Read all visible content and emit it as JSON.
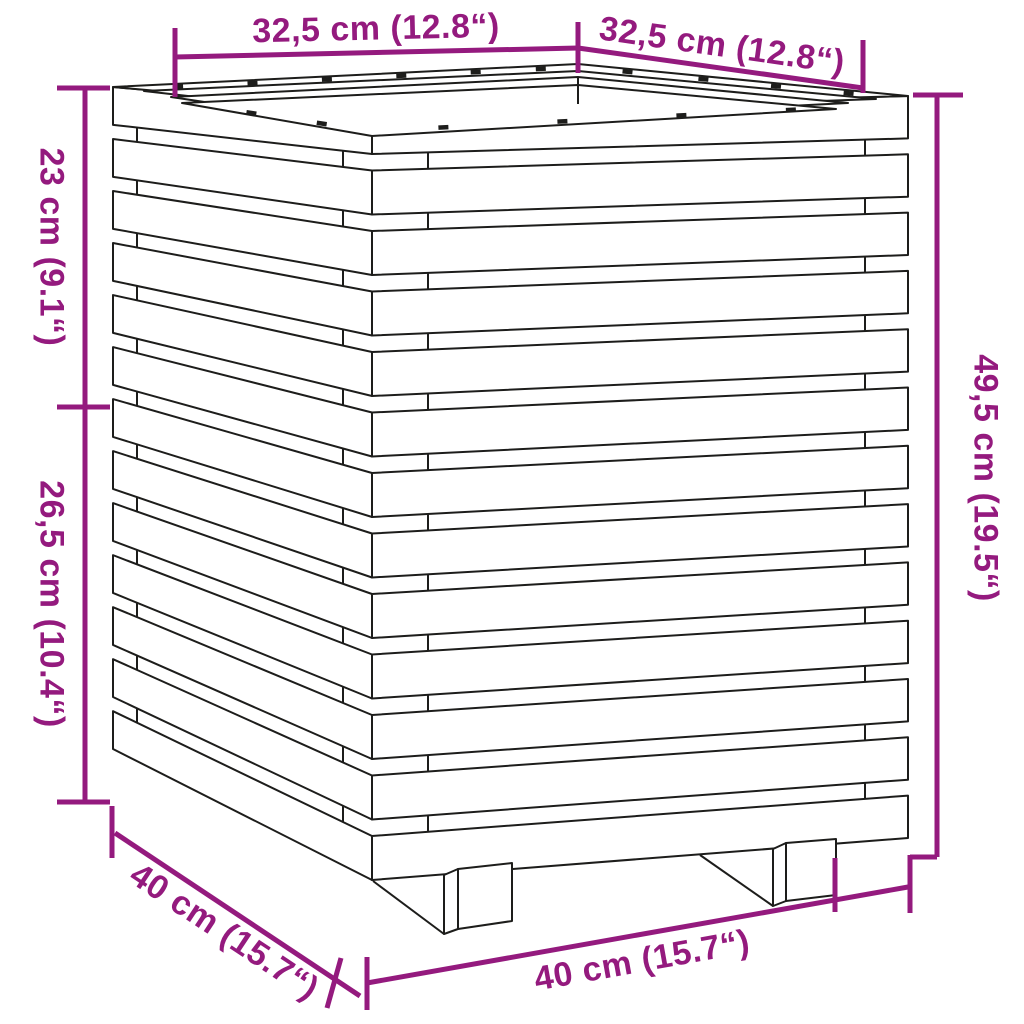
{
  "diagram": {
    "type": "product-dimension-diagram",
    "subject": "slatted wooden planter with two feet",
    "colors": {
      "dimension_accent": "#941A7E",
      "outline": "#1D1D1B",
      "background": "#FFFFFF"
    },
    "dimensions": {
      "top_left_width": "32,5 cm (12.8“)",
      "top_right_width": "32,5 cm (12.8“)",
      "upper_left_height": "23 cm (9.1“)",
      "lower_left_height": "26,5 cm (10.4“)",
      "right_height": "49,5 cm (19.5“)",
      "bottom_depth": "40 cm (15.7“)",
      "bottom_width": "40 cm (15.7“)"
    }
  }
}
